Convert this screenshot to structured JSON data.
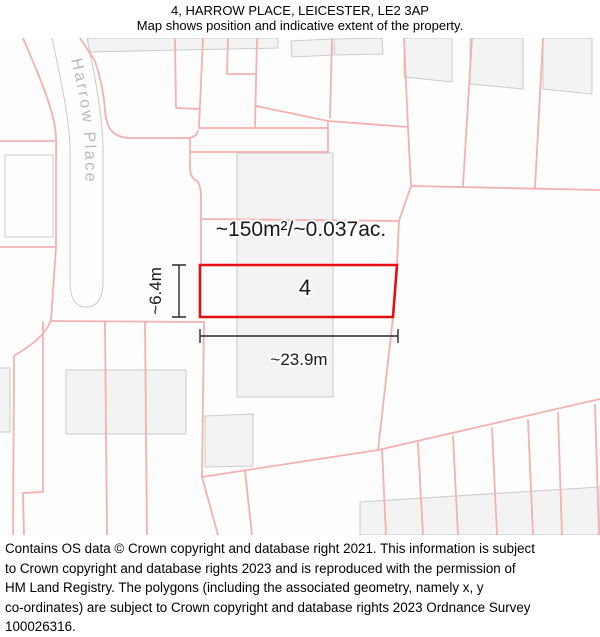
{
  "header": {
    "title": "4, HARROW PLACE, LEICESTER, LE2 3AP",
    "subtitle": "Map shows position and indicative extent of the property."
  },
  "map": {
    "street_label": "Harrow Place",
    "plot": {
      "number": "4",
      "area_label": "~150m²/~0.037ac.",
      "width_label": "~23.9m",
      "height_label": "~6.4m",
      "outline_color": "#e60e0e"
    },
    "colors": {
      "boundary_pink": "#f5b0b0",
      "building_fill": "#f3f3f3",
      "building_stroke": "#cbcbcb",
      "road_stroke": "#c9c9c9",
      "street_label_color": "#b9b9b9",
      "dimension_color": "#2a2a2a",
      "map_background": "#fdfdfd"
    }
  },
  "footer": {
    "lines": [
      "Contains OS data © Crown copyright and database right 2021. This information is subject",
      "to Crown copyright and database rights 2023 and is reproduced with the permission of",
      "HM Land Registry. The polygons (including the associated geometry, namely x, y",
      "co-ordinates) are subject to Crown copyright and database rights 2023 Ordnance Survey",
      "100026316."
    ]
  }
}
